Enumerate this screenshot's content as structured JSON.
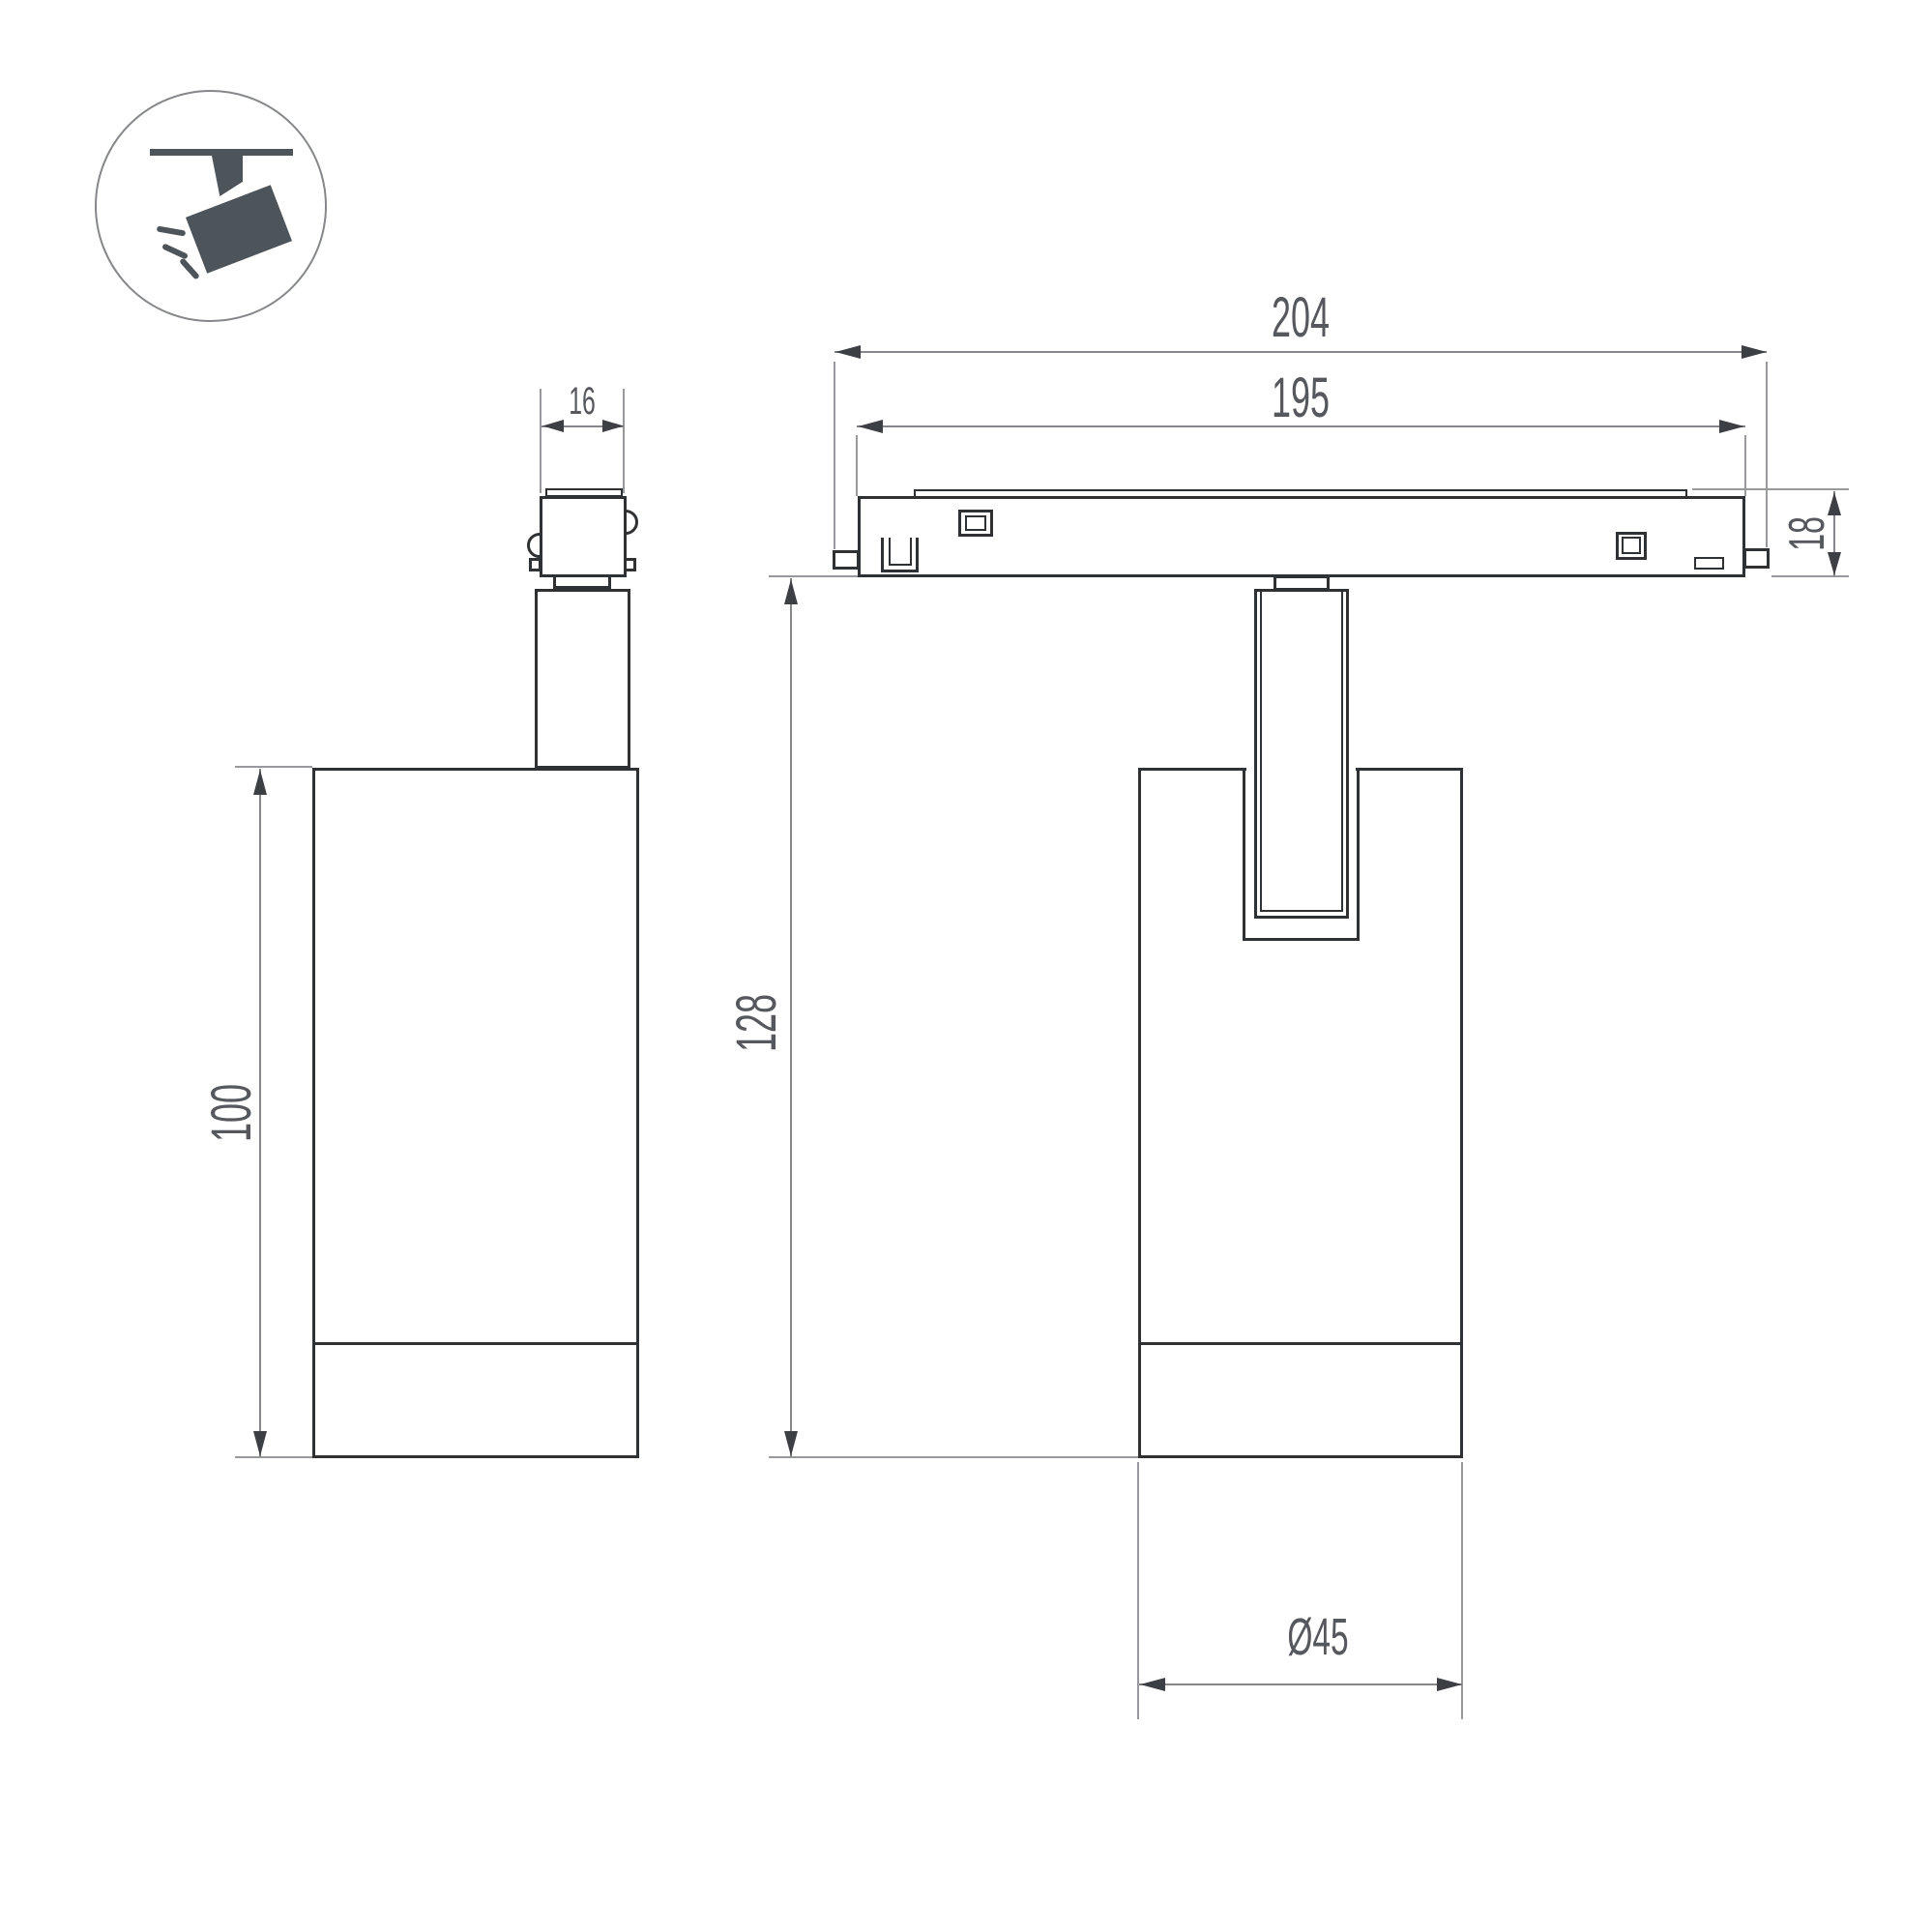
{
  "drawing": {
    "type": "technical-dimension-drawing",
    "subject": "magnetic track spotlight, two orthographic views with pictogram",
    "background": "#ffffff",
    "object_line_color": "#2f3235",
    "dimension_line_color": "#85878a",
    "text_color": "#55585c",
    "icon_fill": "#4d545a"
  },
  "icon": {
    "name": "track-spotlight-pictogram"
  },
  "dimensions": {
    "adapter_width": "16",
    "body_height": "100",
    "track_length_outer": "204",
    "track_length_inner": "195",
    "track_height": "18",
    "overall_height": "128",
    "body_diameter": "Ø45"
  }
}
